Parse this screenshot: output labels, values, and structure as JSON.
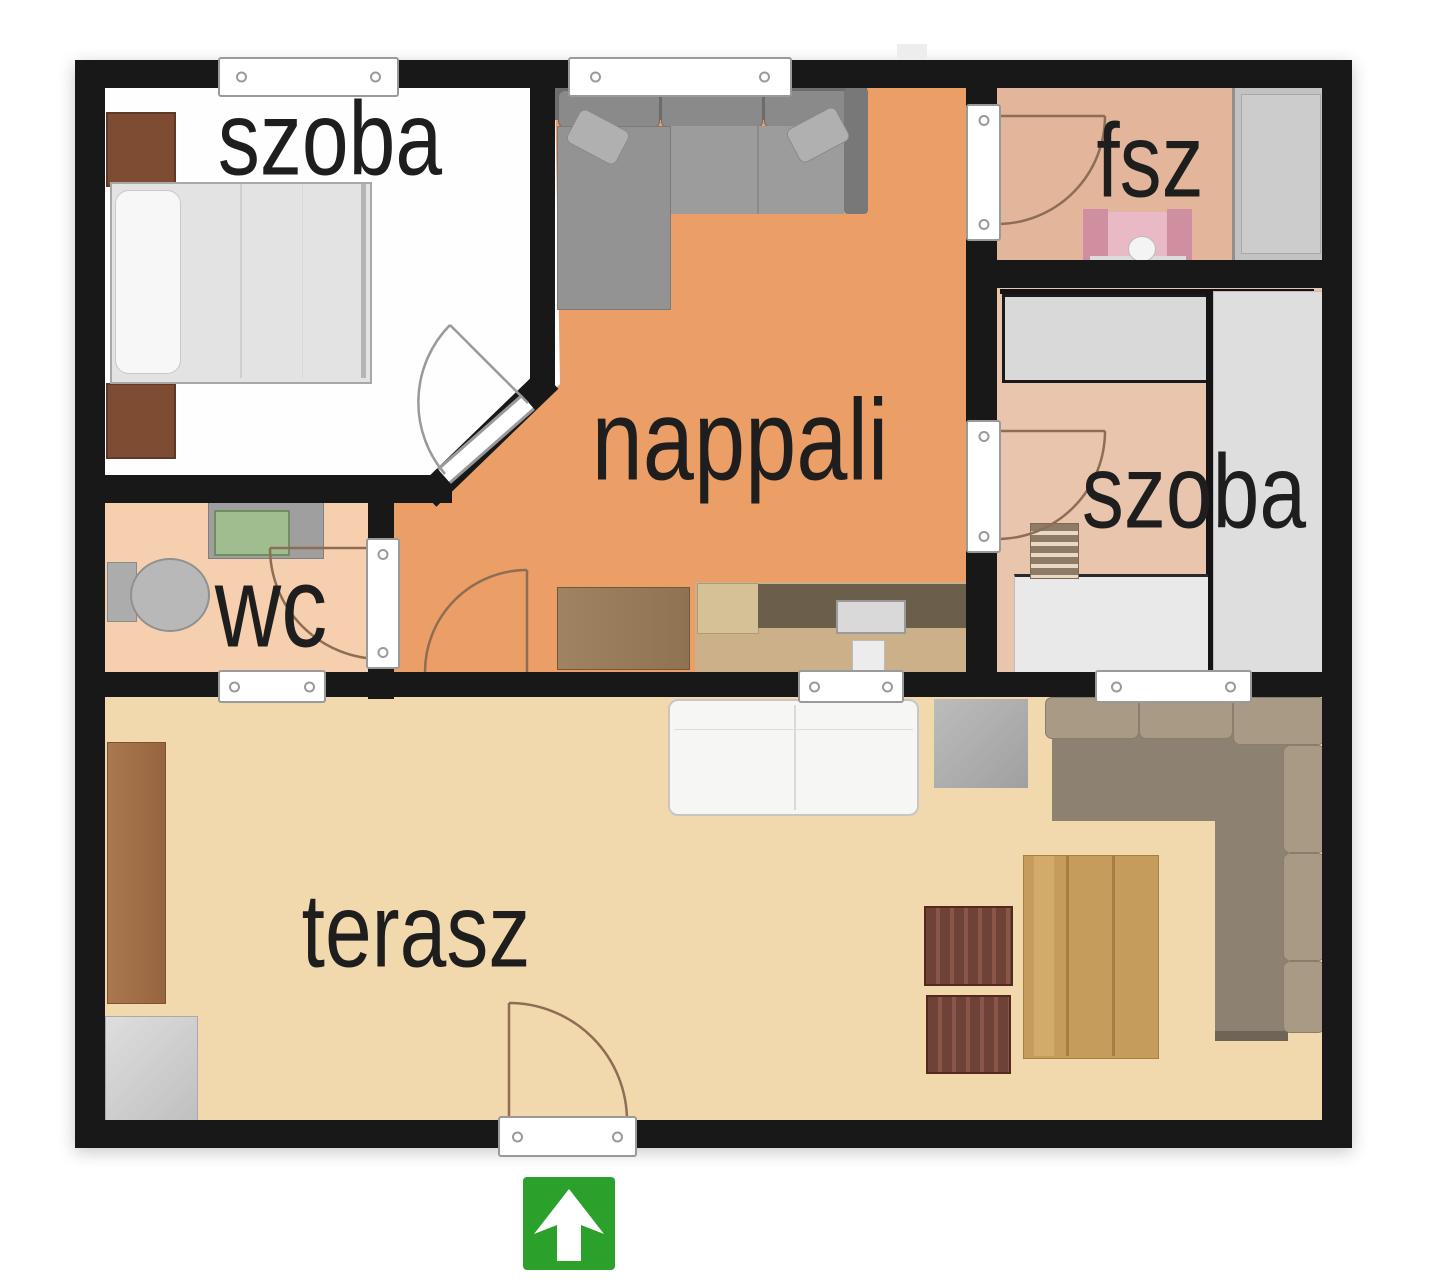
{
  "rooms": [
    {
      "id": "bedroom-1",
      "label": "szoba"
    },
    {
      "id": "living-room",
      "label": "nappali"
    },
    {
      "id": "bathroom",
      "label": "fsz"
    },
    {
      "id": "bedroom-2",
      "label": "szoba"
    },
    {
      "id": "wc",
      "label": "wc"
    },
    {
      "id": "terrace",
      "label": "terasz"
    }
  ],
  "entrance": {
    "icon": "up-arrow"
  },
  "colors": {
    "wall": "#181818",
    "label_text": "#1e1e1e",
    "living_floor": "#ec9e67",
    "kitchen_floor": "#cbb089",
    "terrace_floor": "#f2d9ad",
    "wc_floor": "#f6d0ae",
    "bath_floor": "#e3b69b",
    "bedroom1_floor": "#fefefe",
    "bedroom2_floor": "#eac5ae",
    "entrance_green": "#2ba12b",
    "door_arc": "#8d6e54",
    "window_frame": "#9a9a9a"
  }
}
